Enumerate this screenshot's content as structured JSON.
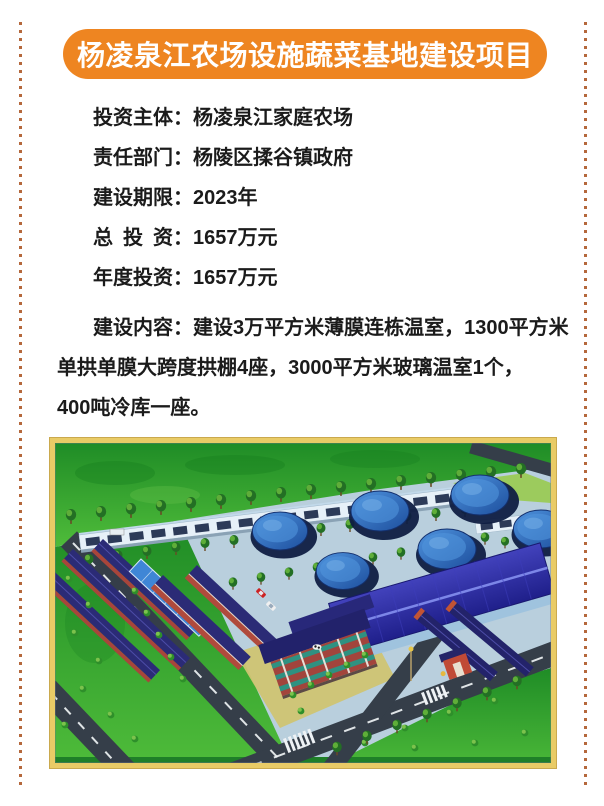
{
  "banner": {
    "title": "杨凌泉江农场设施蔬菜基地建设项目"
  },
  "info": {
    "rows": [
      {
        "label": "投资主体：",
        "value": "杨凌泉江家庭农场"
      },
      {
        "label": "责任部门：",
        "value": "杨陵区揉谷镇政府"
      },
      {
        "label": "建设期限：",
        "value": "2023年"
      },
      {
        "label": "总 投 资：",
        "value": "1657万元"
      },
      {
        "label": "年度投资：",
        "value": "1657万元"
      }
    ],
    "content_lines": [
      "建设内容：建设3万平方米薄膜连栋温室，1300平方米",
      "单拱单膜大跨度拱棚4座，3000平方米玻璃温室1个，",
      "400吨冷库一座。"
    ]
  },
  "colors": {
    "banner_orange": "#ee8521",
    "dotted_border": "#b5683c",
    "photo_frame_gold": "#e9cb66"
  }
}
